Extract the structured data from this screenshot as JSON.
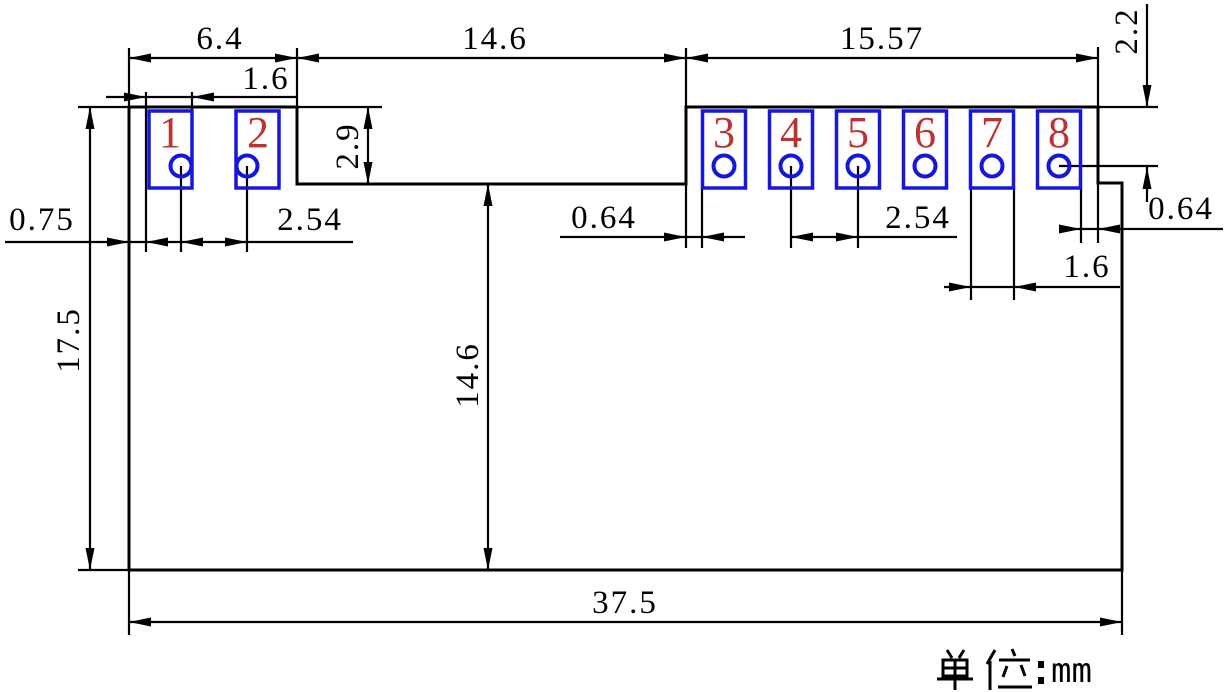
{
  "drawing": {
    "unit_label": "单位：",
    "unit_value": "mm",
    "pins": [
      "1",
      "2",
      "3",
      "4",
      "5",
      "6",
      "7",
      "8"
    ],
    "dimensions": {
      "top_left_span": "6.4",
      "left_pad_width": "1.6",
      "top_middle_span": "14.6",
      "top_right_span": "15.57",
      "pin_center_offset": "2.2",
      "notch_depth": "2.9",
      "edge_to_pad_gap": "0.75",
      "left_pin_pitch": "2.54",
      "body_to_pad3_gap": "0.64",
      "right_pin_pitch": "2.54",
      "pad8_to_edge_gap": "0.64",
      "right_pad_width": "1.6",
      "overall_height": "17.5",
      "lower_body_height": "14.6",
      "overall_width": "37.5"
    },
    "colors": {
      "line": "#000000",
      "pad_outline": "#1616DE",
      "pin_number": "#C03030",
      "background": "#FFFFFF"
    }
  }
}
